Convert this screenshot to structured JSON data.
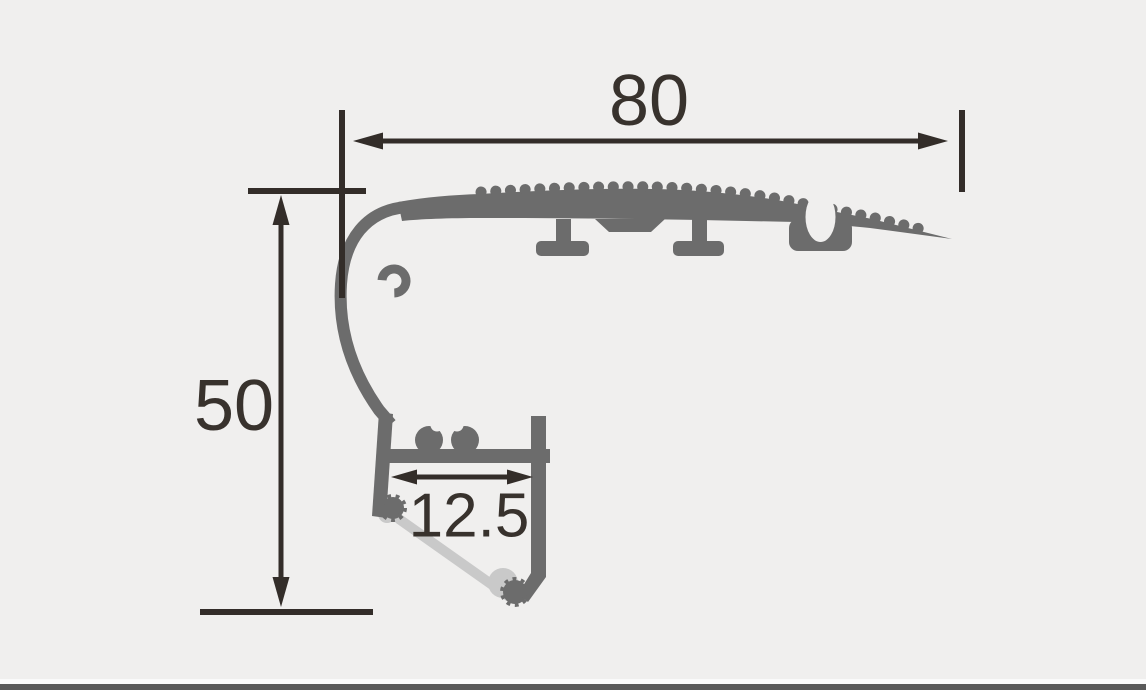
{
  "drawing": {
    "kind": "technical-cross-section-drawing",
    "background_color": "#f0efee",
    "profile_color": "#6c6c6c",
    "diffuser_color": "#c9c9c9",
    "dimension_color": "#332d29",
    "footer_bar_color": "#595959",
    "footer_highlight_color": "#fafafa",
    "dimensions": {
      "overall_width": {
        "label": "80"
      },
      "overall_height": {
        "label": "50"
      },
      "channel_width": {
        "label": "12.5"
      }
    }
  }
}
